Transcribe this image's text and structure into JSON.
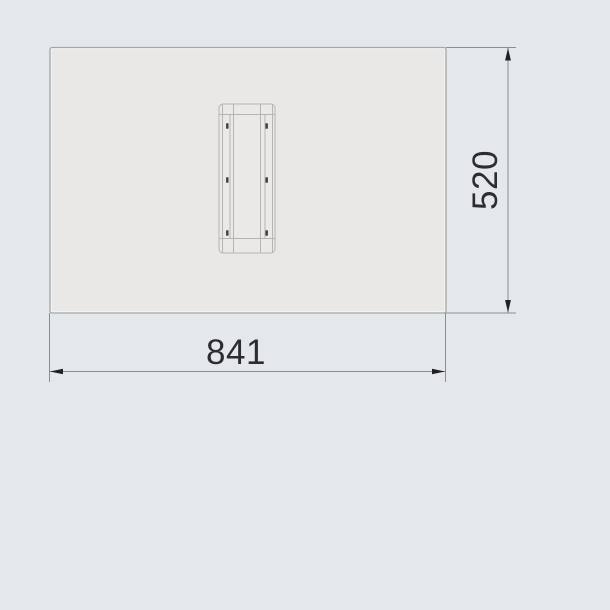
{
  "drawing": {
    "kind": "technical-dimension-drawing",
    "dimensions": {
      "width": {
        "value": "841"
      },
      "height": {
        "value": "520"
      }
    },
    "colors": {
      "background": "#e5e8eb",
      "panel_fill": "#e9e8e6",
      "panel_stroke": "#a4a6a8",
      "panel_inner_highlight": "#f4f3f1",
      "detail_fill": "#eae9e7",
      "detail_stroke": "#b5b5b5",
      "dimension_line": "#8b8e91",
      "arrow_fill": "#1e2023",
      "mark_fill": "#3b3d3f",
      "text_color": "#2b2d30"
    }
  }
}
